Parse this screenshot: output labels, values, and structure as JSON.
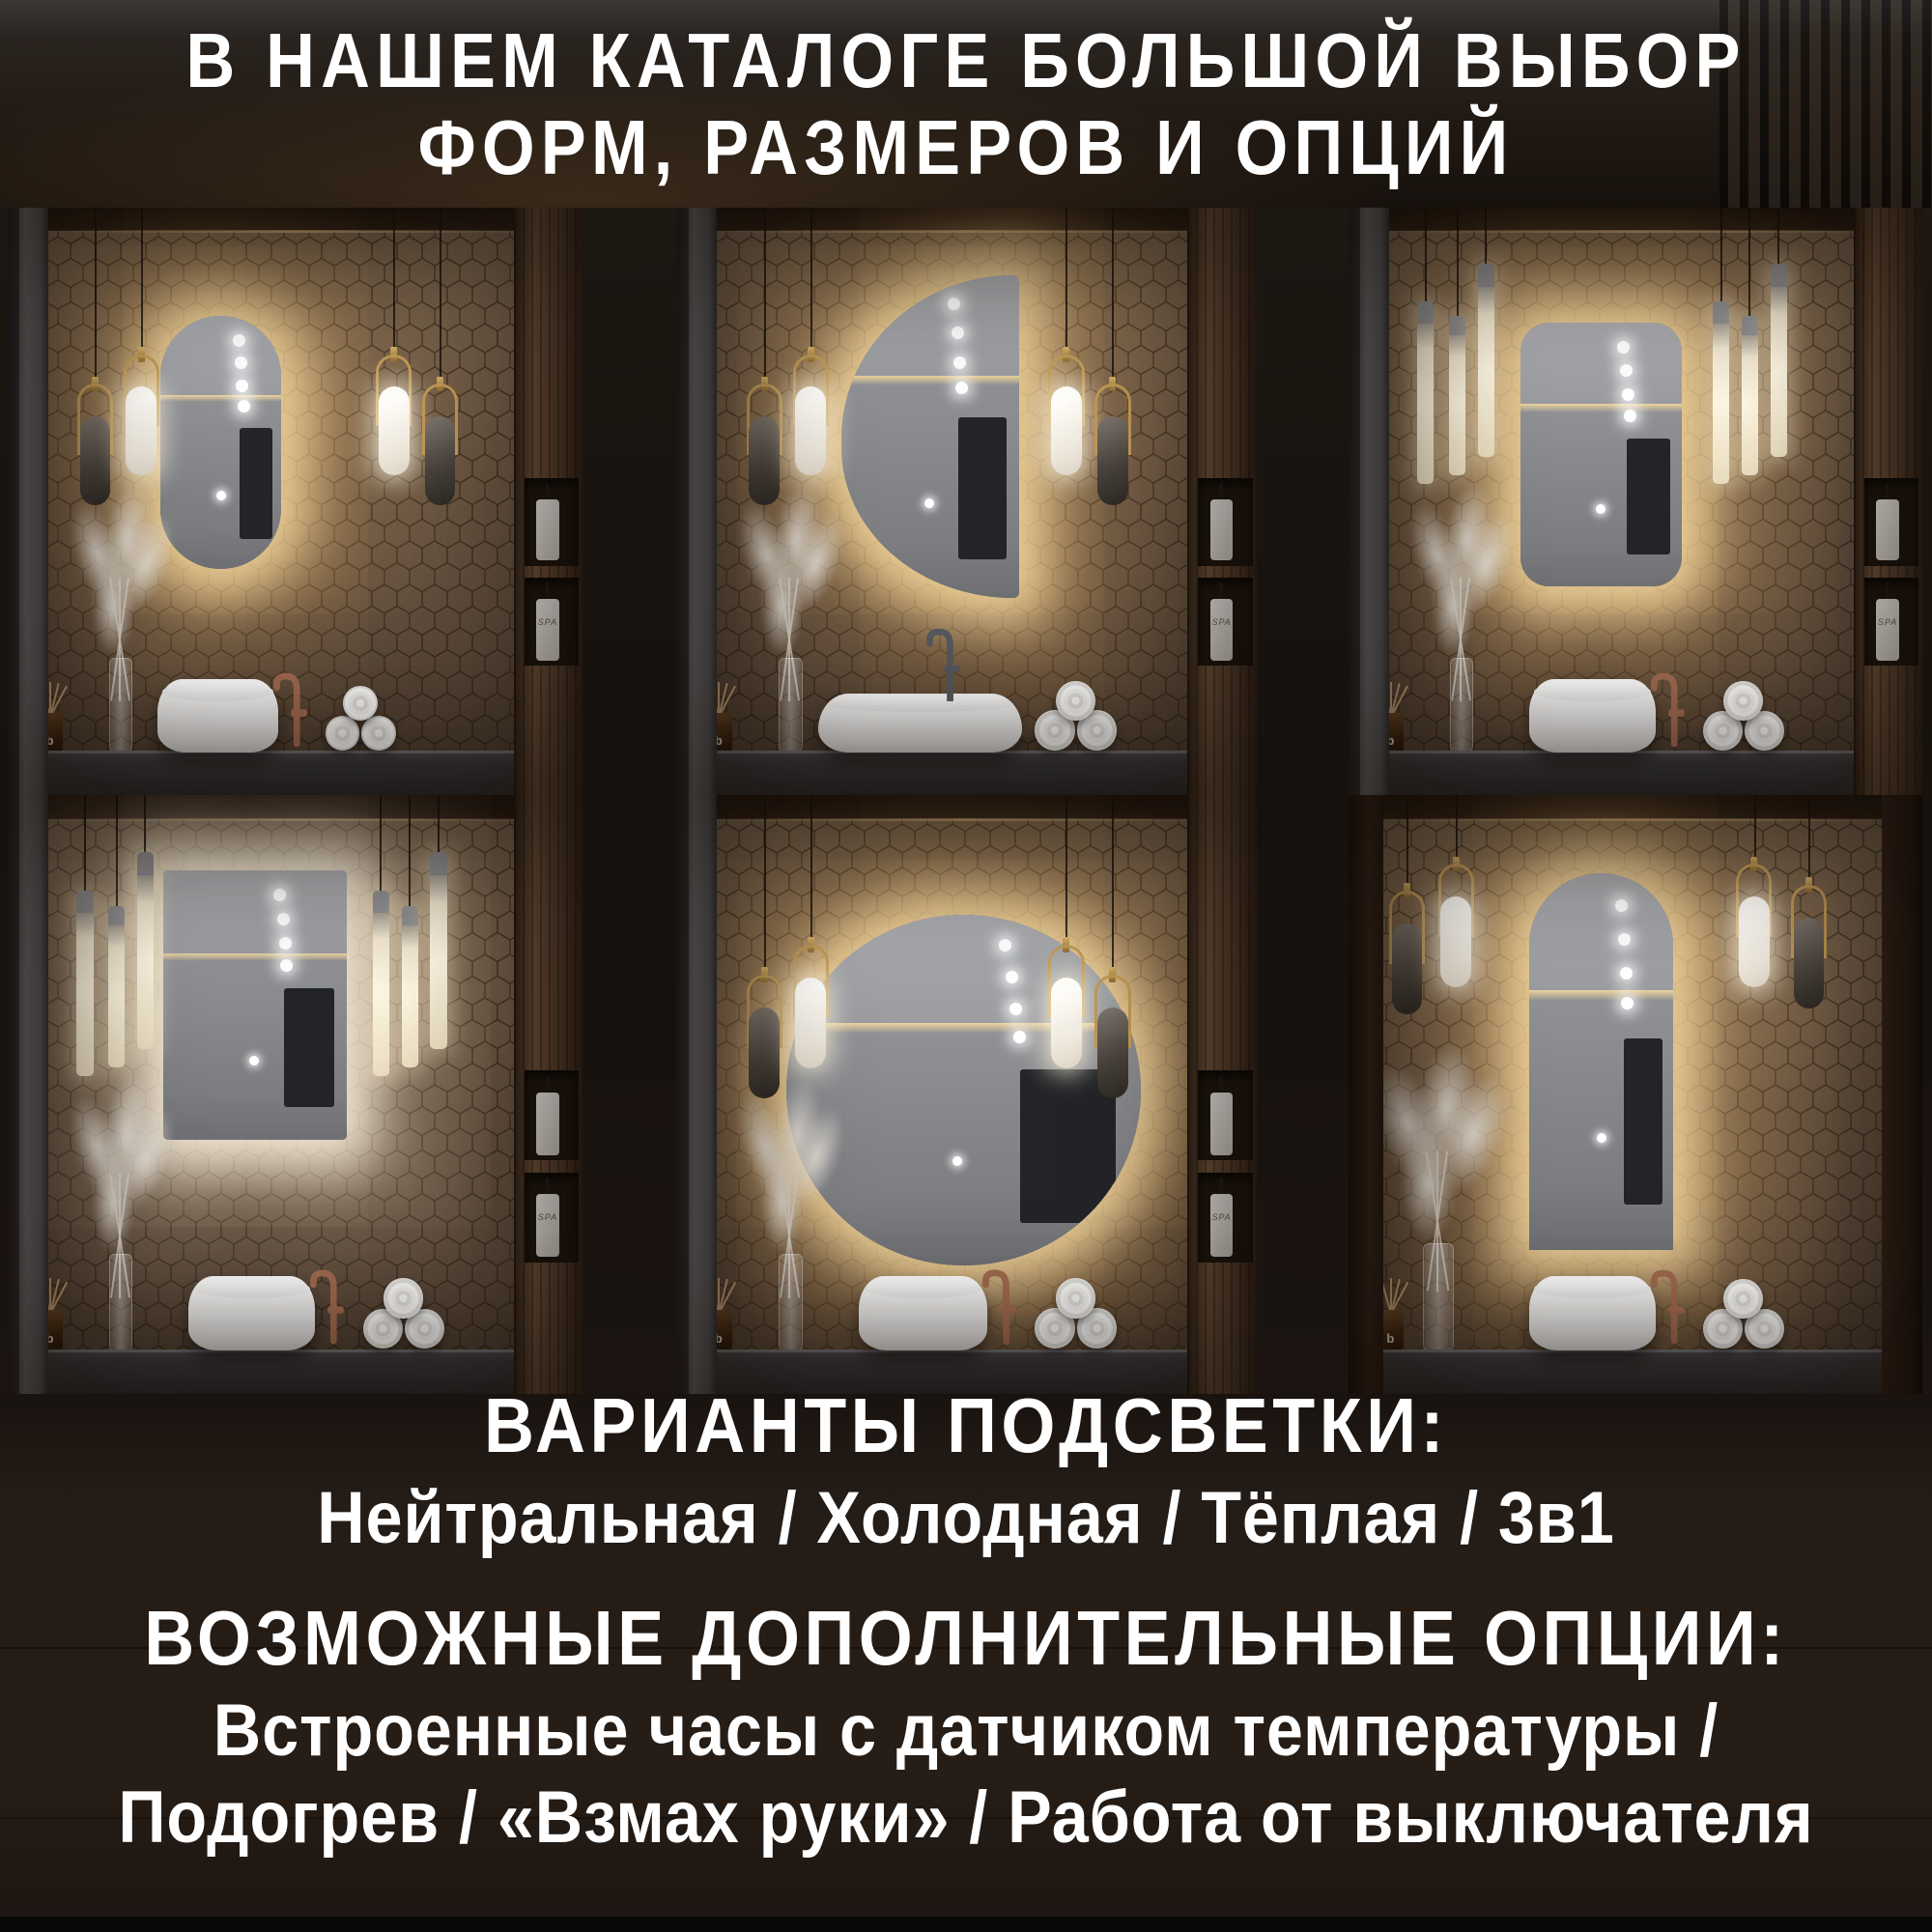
{
  "header": {
    "line1": "В НАШЕМ КАТАЛОГЕ БОЛЬШОЙ ВЫБОР",
    "line2": "ФОРМ, РАЗМЕРОВ И ОПЦИЙ"
  },
  "footer": {
    "lighting_title": "ВАРИАНТЫ ПОДСВЕТКИ:",
    "lighting_options": "Нейтральная / Холодная / Тёплая / 3в1",
    "options_title": "ВОЗМОЖНЫЕ ДОПОЛНИТЕЛЬНЫЕ ОПЦИИ:",
    "options_line1": "Встроенные часы с датчиком температуры /",
    "options_line2": "Подогрев / «Взмах руки» / Работа от выключателя"
  },
  "decor": {
    "diffuser_letter": "b",
    "bottle_label": "SPA"
  },
  "colors": {
    "text": "#ffffff",
    "glow_warm": "#ffe2a6",
    "glow_neutral": "#fff5e2",
    "faucet_copper": "#a06a50",
    "faucet_graphite": "#56585c",
    "countertop": "#3a3a3c",
    "mosaic_wall": "#715c48"
  },
  "tiles": [
    {
      "id": 1,
      "mirror_shape": "oval-pill",
      "light": "warm",
      "pendants": "capsule",
      "sink": "round",
      "faucet": "copper",
      "sides": "grey"
    },
    {
      "id": 2,
      "mirror_shape": "half-moon",
      "light": "warm",
      "pendants": "capsule",
      "sink": "wide",
      "faucet": "graphite",
      "sides": "grey"
    },
    {
      "id": 3,
      "mirror_shape": "rounded-rectangle",
      "light": "warm",
      "pendants": "tubes",
      "sink": "round",
      "faucet": "copper",
      "sides": "grey"
    },
    {
      "id": 4,
      "mirror_shape": "rectangle",
      "light": "neutral",
      "pendants": "tubes",
      "sink": "round",
      "faucet": "copper",
      "sides": "grey"
    },
    {
      "id": 5,
      "mirror_shape": "round",
      "light": "warm",
      "pendants": "capsule",
      "sink": "round",
      "faucet": "copper",
      "sides": "grey"
    },
    {
      "id": 6,
      "mirror_shape": "arch",
      "light": "warm",
      "pendants": "capsule",
      "sink": "round",
      "faucet": "copper",
      "sides": "dark"
    }
  ]
}
